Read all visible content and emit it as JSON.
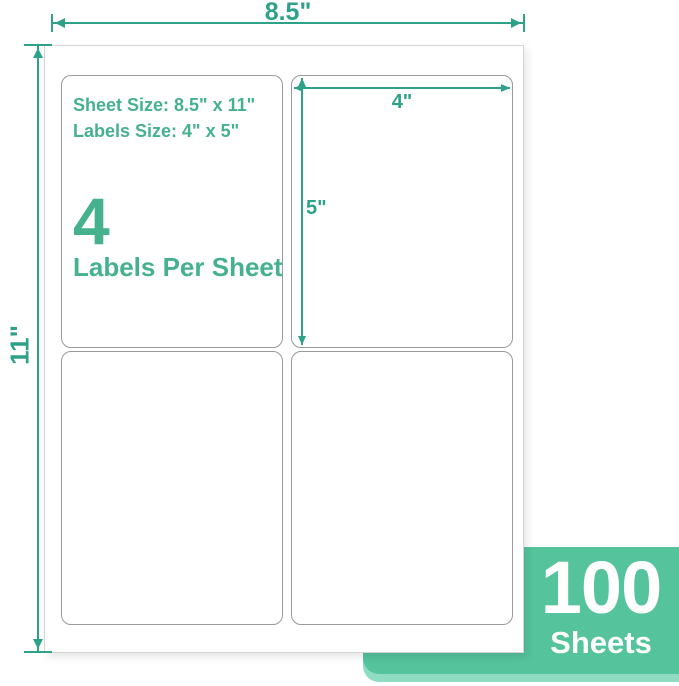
{
  "colors": {
    "accent": "#2ea189",
    "text_green": "#46b18d",
    "badge_green": "#55c49d",
    "badge_edge_green": "#90dcc3",
    "label_border": "#9a9a9a",
    "sheet_border": "#d4d4d4"
  },
  "dimensions": {
    "sheet_width_label": "8.5\"",
    "sheet_height_label": "11\"",
    "label_width_label": "4\"",
    "label_height_label": "5\""
  },
  "label_info": {
    "sheet_size_line": "Sheet Size: 8.5\" x 11\"",
    "labels_size_line": "Labels Size: 4\" x 5\"",
    "count_number": "4",
    "count_caption": "Labels Per Sheet"
  },
  "badge": {
    "count": "100",
    "unit": "Sheets"
  }
}
